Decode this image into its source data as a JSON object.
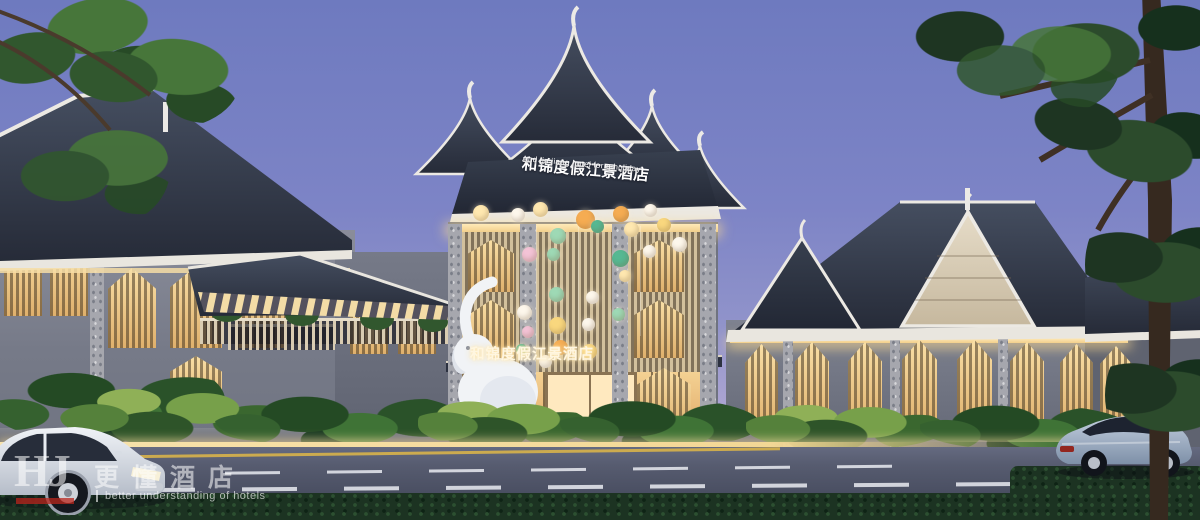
{
  "signs": {
    "main": {
      "cn": "和锦度假江景酒店",
      "en": "And jin jiang hotel for a holiday"
    },
    "entrance": {
      "cn": "和锦度假江景酒店"
    }
  },
  "watermark": {
    "monogram": "HJ",
    "cn": "更懂酒店",
    "en": "better understanding of hotels"
  },
  "colors": {
    "sky_top": "#6e7abf",
    "sky_horizon": "#c0b4da",
    "roof_tile": "#343b4a",
    "roof_trim": "#ece9e3",
    "gable_cream": "#d9cfbd",
    "wall_gray": "#7b7f8c",
    "window_glow": "#f6dda6",
    "curb_light": "#f7e3ad",
    "foliage_dark": "#1e3522",
    "foliage_light": "#77a04a",
    "road": "#4a4f62",
    "hedge": "#1c3322",
    "car_white": "#e7ebf0",
    "car_silver_blue": "#9fb0c4",
    "balloon_palette": [
      "#fdf7ec",
      "#ffe8b0",
      "#f5ac52",
      "#f9d77e",
      "#9ed9b5",
      "#56b892",
      "#f3c3d6"
    ]
  }
}
